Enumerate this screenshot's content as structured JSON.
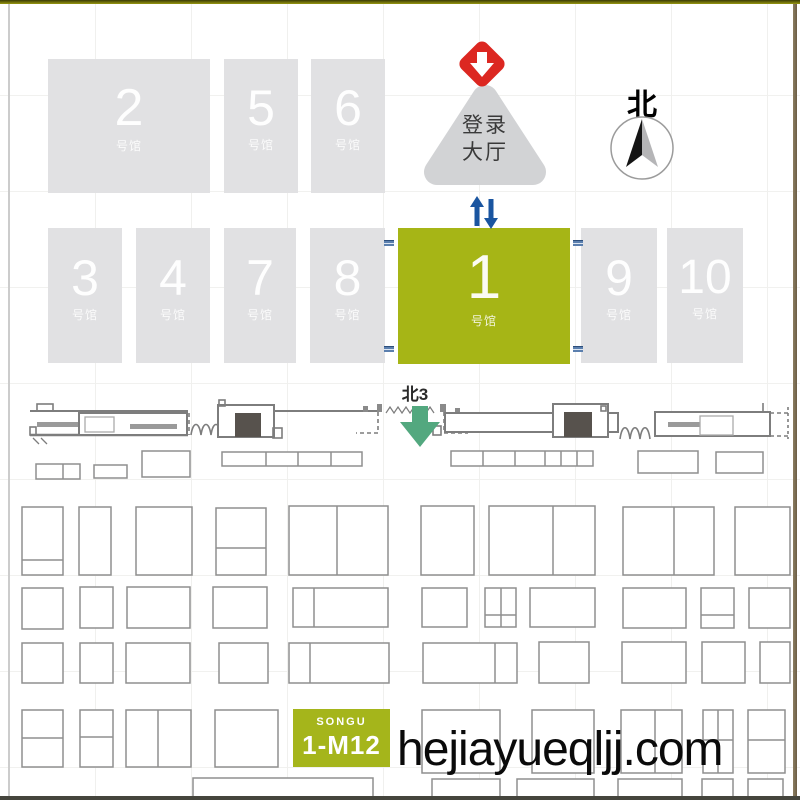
{
  "map": {
    "watermark": "hejiayueqljj.com",
    "compass": {
      "label": "北"
    },
    "gate": {
      "label": "北3"
    },
    "lobby": {
      "line1": "登录",
      "line2": "大厅"
    },
    "booth_highlight": {
      "brand": "SONGU",
      "code": "1-M12",
      "x": 293,
      "y": 709,
      "w": 97,
      "h": 58
    },
    "colors": {
      "hall_gray": "#e1e1e3",
      "hall_selected_green": "#a6b516",
      "booth_green": "#a5b51b",
      "entrance_red": "#dc2721",
      "arrow_blue": "#1a55a0",
      "gate_arrow_green": "#53a87f",
      "compass_dark": "#141414",
      "compass_light": "#b5b5b7",
      "booth_stroke": "#8f8f8f",
      "facade_stroke": "#7d7d7d"
    },
    "halls": [
      {
        "num": "2",
        "sub": "号馆",
        "x": 48,
        "y": 59,
        "w": 162,
        "h": 134,
        "numSize": 52,
        "highlight": false
      },
      {
        "num": "5",
        "sub": "号馆",
        "x": 224,
        "y": 59,
        "w": 74,
        "h": 134,
        "numSize": 50,
        "highlight": false
      },
      {
        "num": "6",
        "sub": "号馆",
        "x": 311,
        "y": 59,
        "w": 74,
        "h": 134,
        "numSize": 50,
        "highlight": false
      },
      {
        "num": "3",
        "sub": "号馆",
        "x": 48,
        "y": 228,
        "w": 74,
        "h": 135,
        "numSize": 50,
        "highlight": false
      },
      {
        "num": "4",
        "sub": "号馆",
        "x": 136,
        "y": 228,
        "w": 74,
        "h": 135,
        "numSize": 50,
        "highlight": false
      },
      {
        "num": "7",
        "sub": "号馆",
        "x": 224,
        "y": 228,
        "w": 72,
        "h": 135,
        "numSize": 50,
        "highlight": false
      },
      {
        "num": "8",
        "sub": "号馆",
        "x": 310,
        "y": 228,
        "w": 75,
        "h": 135,
        "numSize": 50,
        "highlight": false
      },
      {
        "num": "1",
        "sub": "号馆",
        "x": 398,
        "y": 228,
        "w": 172,
        "h": 136,
        "numSize": 62,
        "highlight": true
      },
      {
        "num": "9",
        "sub": "号馆",
        "x": 581,
        "y": 228,
        "w": 76,
        "h": 135,
        "numSize": 50,
        "highlight": false
      },
      {
        "num": "10",
        "sub": "号馆",
        "x": 667,
        "y": 228,
        "w": 76,
        "h": 135,
        "numSize": 48,
        "highlight": false
      }
    ],
    "door_markers": [
      {
        "x": 384,
        "y": 240
      },
      {
        "x": 573,
        "y": 240
      },
      {
        "x": 384,
        "y": 346
      },
      {
        "x": 573,
        "y": 346
      }
    ],
    "booths": [
      {
        "x": 36,
        "y": 464,
        "w": 44,
        "h": 15,
        "vd": [
          63
        ]
      },
      {
        "x": 94,
        "y": 465,
        "w": 33,
        "h": 13
      },
      {
        "x": 142,
        "y": 451,
        "w": 48,
        "h": 26
      },
      {
        "x": 222,
        "y": 452,
        "w": 140,
        "h": 14,
        "vd": [
          266,
          298,
          331
        ]
      },
      {
        "x": 451,
        "y": 451,
        "w": 142,
        "h": 15,
        "vd": [
          483,
          515,
          545,
          561,
          577
        ]
      },
      {
        "x": 638,
        "y": 451,
        "w": 60,
        "h": 22
      },
      {
        "x": 716,
        "y": 452,
        "w": 47,
        "h": 21
      },
      {
        "x": 22,
        "y": 507,
        "w": 41,
        "h": 68,
        "hd": [
          560
        ]
      },
      {
        "x": 79,
        "y": 507,
        "w": 32,
        "h": 68
      },
      {
        "x": 136,
        "y": 507,
        "w": 56,
        "h": 68
      },
      {
        "x": 216,
        "y": 508,
        "w": 50,
        "h": 67,
        "hd": [
          548
        ]
      },
      {
        "x": 289,
        "y": 506,
        "w": 99,
        "h": 69,
        "vd": [
          337
        ]
      },
      {
        "x": 421,
        "y": 506,
        "w": 53,
        "h": 69
      },
      {
        "x": 489,
        "y": 506,
        "w": 106,
        "h": 69,
        "vd": [
          553
        ]
      },
      {
        "x": 623,
        "y": 507,
        "w": 91,
        "h": 68,
        "vd": [
          674
        ]
      },
      {
        "x": 735,
        "y": 507,
        "w": 55,
        "h": 68
      },
      {
        "x": 22,
        "y": 588,
        "w": 41,
        "h": 41
      },
      {
        "x": 80,
        "y": 587,
        "w": 33,
        "h": 41
      },
      {
        "x": 127,
        "y": 587,
        "w": 63,
        "h": 41
      },
      {
        "x": 213,
        "y": 587,
        "w": 54,
        "h": 41
      },
      {
        "x": 293,
        "y": 588,
        "w": 95,
        "h": 39,
        "vd": [
          314
        ]
      },
      {
        "x": 422,
        "y": 588,
        "w": 45,
        "h": 39
      },
      {
        "x": 485,
        "y": 588,
        "w": 31,
        "h": 39,
        "vd": [
          501
        ],
        "hd": [
          615
        ]
      },
      {
        "x": 530,
        "y": 588,
        "w": 65,
        "h": 39
      },
      {
        "x": 623,
        "y": 588,
        "w": 63,
        "h": 40
      },
      {
        "x": 701,
        "y": 588,
        "w": 33,
        "h": 40,
        "hd": [
          615
        ]
      },
      {
        "x": 749,
        "y": 588,
        "w": 41,
        "h": 40
      },
      {
        "x": 22,
        "y": 643,
        "w": 41,
        "h": 40
      },
      {
        "x": 80,
        "y": 643,
        "w": 33,
        "h": 40
      },
      {
        "x": 126,
        "y": 643,
        "w": 64,
        "h": 40
      },
      {
        "x": 219,
        "y": 643,
        "w": 49,
        "h": 40
      },
      {
        "x": 289,
        "y": 643,
        "w": 100,
        "h": 40,
        "vd": [
          310
        ]
      },
      {
        "x": 423,
        "y": 643,
        "w": 94,
        "h": 40,
        "vd": [
          495
        ]
      },
      {
        "x": 539,
        "y": 642,
        "w": 50,
        "h": 41
      },
      {
        "x": 622,
        "y": 642,
        "w": 64,
        "h": 41
      },
      {
        "x": 702,
        "y": 642,
        "w": 43,
        "h": 41
      },
      {
        "x": 760,
        "y": 642,
        "w": 30,
        "h": 41
      },
      {
        "x": 22,
        "y": 710,
        "w": 41,
        "h": 57,
        "hd": [
          738
        ]
      },
      {
        "x": 80,
        "y": 710,
        "w": 33,
        "h": 57,
        "hd": [
          737
        ]
      },
      {
        "x": 126,
        "y": 710,
        "w": 65,
        "h": 57,
        "vd": [
          158
        ]
      },
      {
        "x": 215,
        "y": 710,
        "w": 63,
        "h": 57
      },
      {
        "x": 422,
        "y": 710,
        "w": 78,
        "h": 63
      },
      {
        "x": 532,
        "y": 710,
        "w": 62,
        "h": 63
      },
      {
        "x": 621,
        "y": 710,
        "w": 61,
        "h": 63,
        "vd": [
          655
        ]
      },
      {
        "x": 703,
        "y": 710,
        "w": 30,
        "h": 63,
        "hd": [
          740
        ],
        "vd": [
          718
        ]
      },
      {
        "x": 748,
        "y": 710,
        "w": 37,
        "h": 63,
        "hd": [
          740
        ]
      },
      {
        "x": 193,
        "y": 778,
        "w": 180,
        "h": 19
      },
      {
        "x": 432,
        "y": 779,
        "w": 68,
        "h": 19
      },
      {
        "x": 517,
        "y": 779,
        "w": 77,
        "h": 19
      },
      {
        "x": 618,
        "y": 779,
        "w": 64,
        "h": 19
      },
      {
        "x": 702,
        "y": 779,
        "w": 31,
        "h": 19
      },
      {
        "x": 748,
        "y": 779,
        "w": 35,
        "h": 19
      }
    ]
  }
}
